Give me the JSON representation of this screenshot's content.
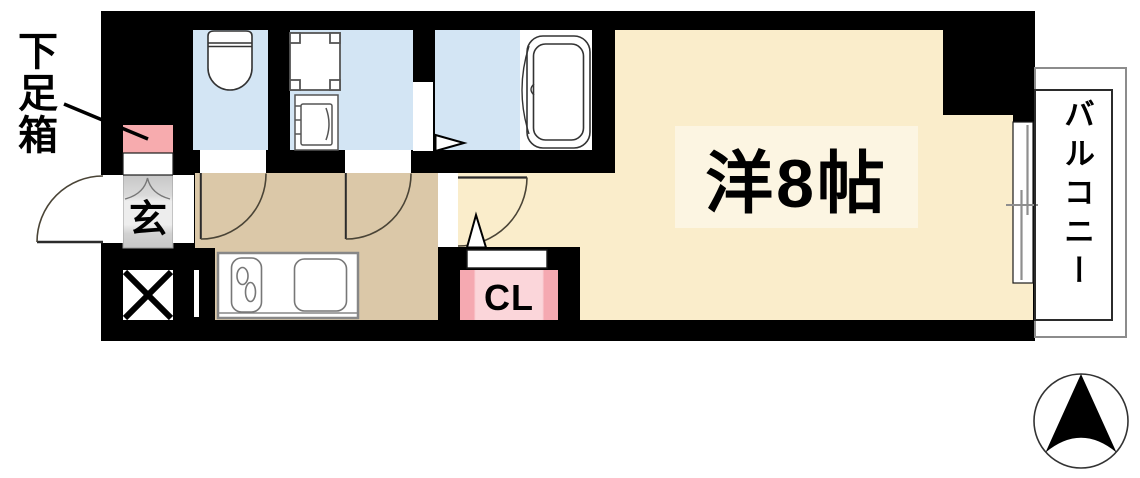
{
  "floorplan": {
    "type": "apartment-floor-plan",
    "labels": {
      "shoe_box": "下足箱",
      "entrance": "玄",
      "closet": "CL",
      "main_room": "洋8帖",
      "balcony": "バルコニー"
    },
    "colors": {
      "wall": "#000000",
      "main_room_floor": "#FAEDCB",
      "main_room_label_bg": "#FCF5E2",
      "kitchen_corridor_floor": "#DBC8A8",
      "wet_area_floor": "#D3E5F4",
      "closet_fill": "#FBD6DA",
      "closet_edge": "#F5A9B1",
      "shoe_box_fill": "#F7ABAE",
      "entrance_floor_light": "#EDEDED",
      "entrance_floor_dark": "#C7C7C7"
    },
    "icons": [
      "toilet-icon",
      "washing-machine-pan-icon",
      "washbasin-icon",
      "bathtub-icon",
      "kitchen-counter-icon",
      "stove-burners-icon",
      "kitchen-sink-icon",
      "pipe-space-x-icon",
      "sliding-window-icon",
      "door-swing-arc-icon",
      "compass-north-icon"
    ]
  }
}
